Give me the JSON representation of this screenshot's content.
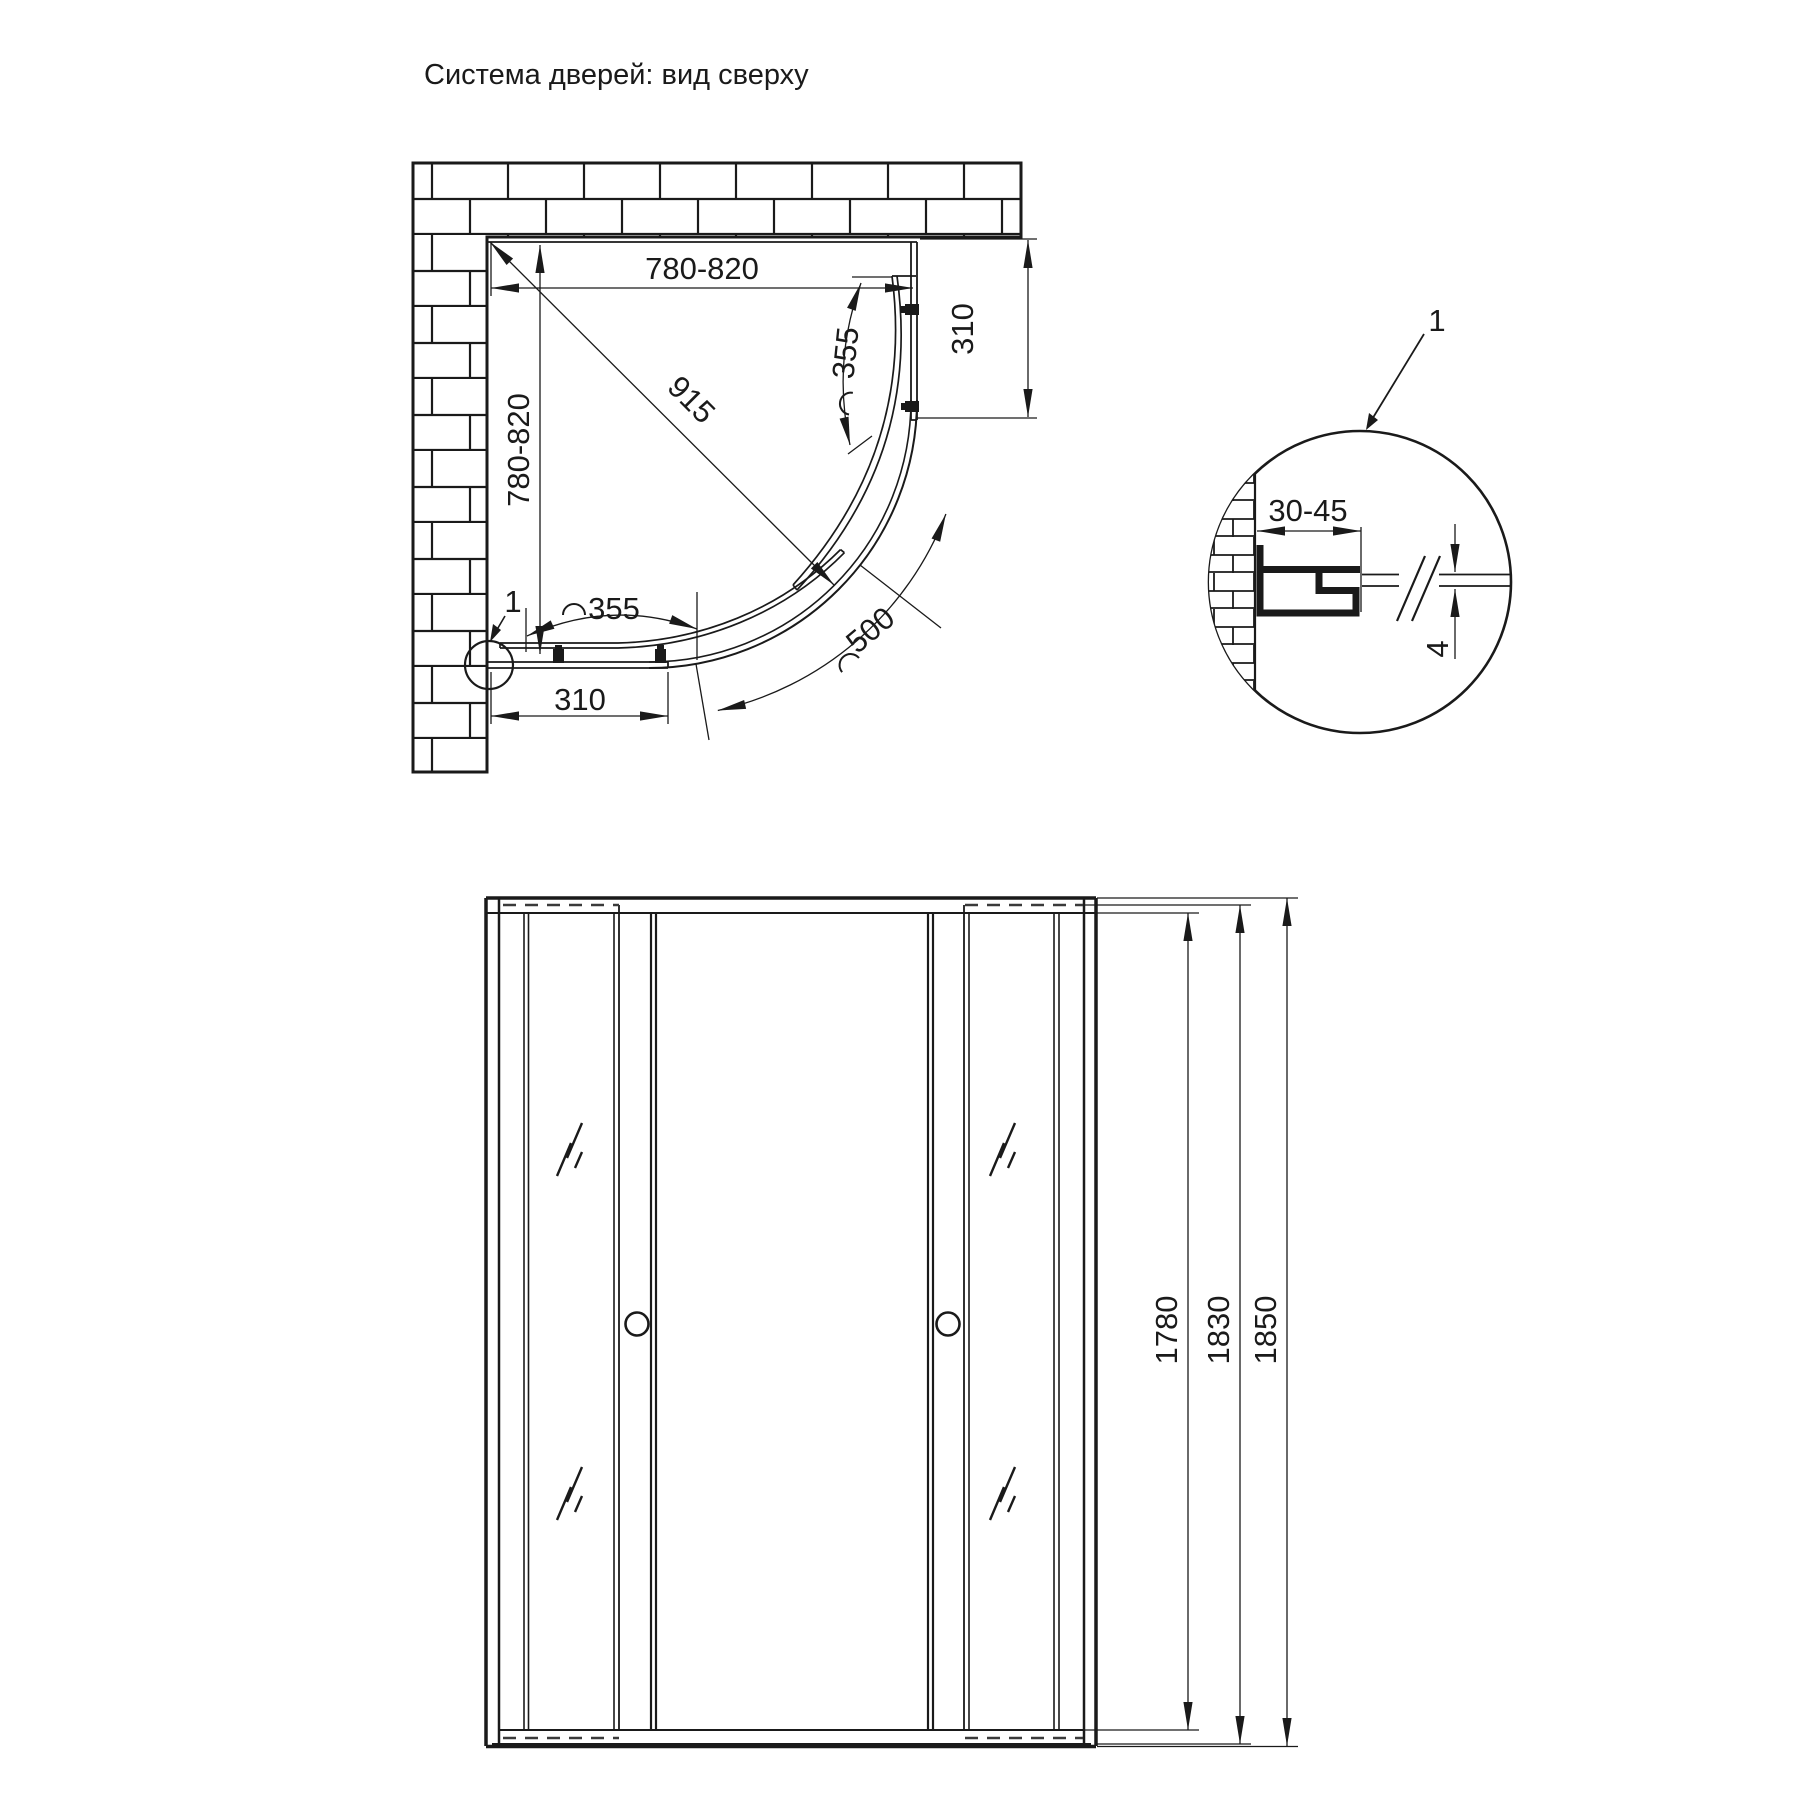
{
  "title": "Система дверей: вид сверху",
  "top_view": {
    "width_range": "780-820",
    "depth_range": "780-820",
    "diagonal": "915",
    "side_fixed_width_right": "310",
    "side_fixed_width_bottom": "310",
    "door_opening_top": "355",
    "door_opening_bottom": "355",
    "radius": "500",
    "detail_marker": "1"
  },
  "detail_view": {
    "marker": "1",
    "wall_profile_adjustment": "30-45",
    "glass_thickness": "4"
  },
  "front_view": {
    "glass_height": "1780",
    "door_height": "1830",
    "total_height": "1850"
  },
  "colors": {
    "line": "#1a1a1a",
    "background": "#ffffff",
    "dashed": "#3a3a3a"
  }
}
